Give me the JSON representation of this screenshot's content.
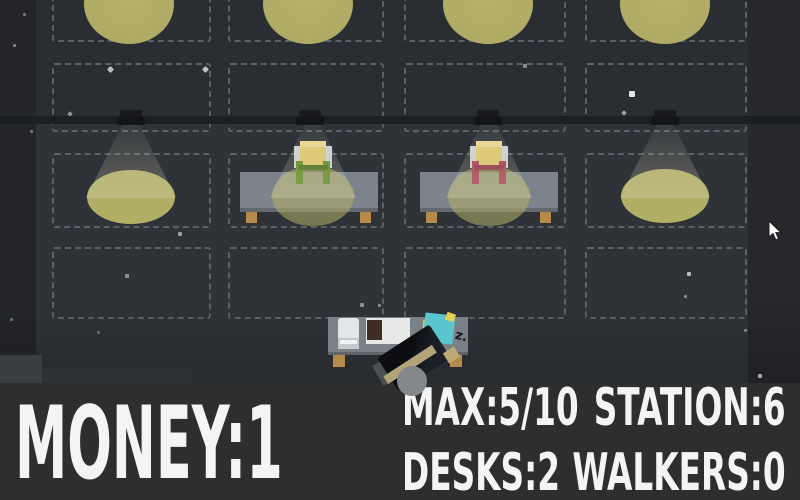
{
  "hud": {
    "money": {
      "text": "MONEY:1",
      "label": "MONEY",
      "value": "1"
    },
    "stats": [
      {
        "id": "max",
        "text": "MAX:5/10",
        "label": "MAX",
        "value": "5/10"
      },
      {
        "id": "station",
        "text": "STATION:6",
        "label": "STATION",
        "value": "6"
      },
      {
        "id": "desks",
        "text": "DESKS:2",
        "label": "DESKS",
        "value": "2"
      },
      {
        "id": "walkers",
        "text": "WALKERS:0",
        "label": "WALKERS",
        "value": "0"
      }
    ]
  },
  "scene": {
    "sleep_indicator": "z.",
    "colors": {
      "floor": "#2f3338",
      "wall": "#1d2023",
      "grid_dash": "#5a6067",
      "light_pool": "#b1ae66",
      "table_gray": "#7d838b",
      "wood_leg": "#b58a4b",
      "chair_seat_yellow": "#e0c66d",
      "chair_accent_green": "#5d8a21",
      "chair_accent_red": "#a63c50",
      "customer_teal": "#5ac5ce",
      "customer_yellow": "#e7cf52",
      "worker_jacket": "#14171c",
      "worker_stripe": "#b2a378",
      "hud_background": "#2d2f2e",
      "hud_text": "#f4f4f4"
    }
  }
}
